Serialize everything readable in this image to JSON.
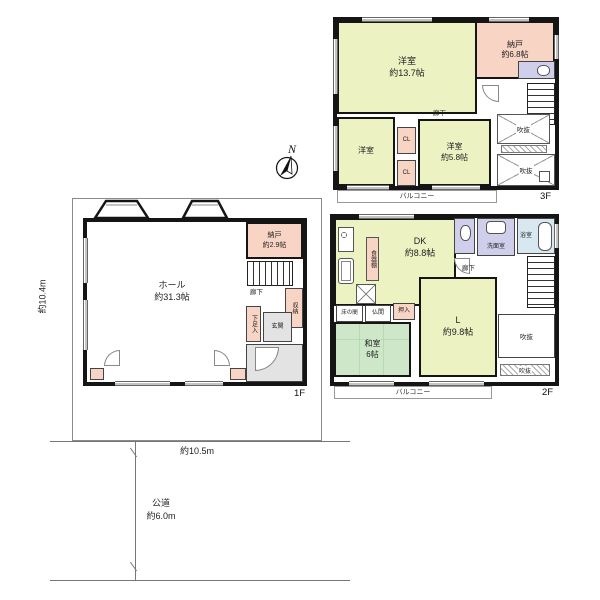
{
  "palette": {
    "wall": "#151515",
    "room_yellow_green": "#edf2c3",
    "room_pink": "#f8d4c4",
    "room_lavender": "#cfcfeb",
    "room_bath_blue": "#d8e8f0",
    "room_tatami_green": "#cde7c8",
    "floor_gray": "#e3e3e3",
    "line_gray": "#808080"
  },
  "compass": {
    "north": "N"
  },
  "floor3": {
    "tag": "3F",
    "balcony": "バルコニー",
    "rooms": {
      "western_large": "洋室\n約13.7帖",
      "closet_68": "納戸\n約6.8帖",
      "western_small": "洋室",
      "western_58": "洋室\n約5.8帖",
      "cl_upper": "CL",
      "cl_lower": "CL",
      "hallway": "廊下",
      "void_upper": "吹抜",
      "void_lower": "吹抜"
    }
  },
  "floor2": {
    "tag": "2F",
    "balcony": "バルコニー",
    "rooms": {
      "dk": "DK\n約8.8帖",
      "cupboard": "食器棚",
      "washroom": "洗面室",
      "bathroom": "浴室",
      "hallway": "廊下",
      "living": "L\n約9.8帖",
      "tokonoma": "床の間",
      "butsuma": "仏間",
      "oshiire": "押入",
      "washitsu": "和室\n6帖",
      "void_main": "吹抜",
      "void_strip": "吹抜"
    }
  },
  "floor1": {
    "tag": "1F",
    "rooms": {
      "hall": "ホール\n約31.3帖",
      "closet_29": "納戸\n約2.9帖",
      "hallway": "廊下",
      "storage": "収納",
      "shoe_closet": "下足入",
      "entrance": "玄関"
    }
  },
  "site": {
    "width": "約10.5m",
    "depth": "約10.4m",
    "road": "公道\n約6.0m"
  }
}
